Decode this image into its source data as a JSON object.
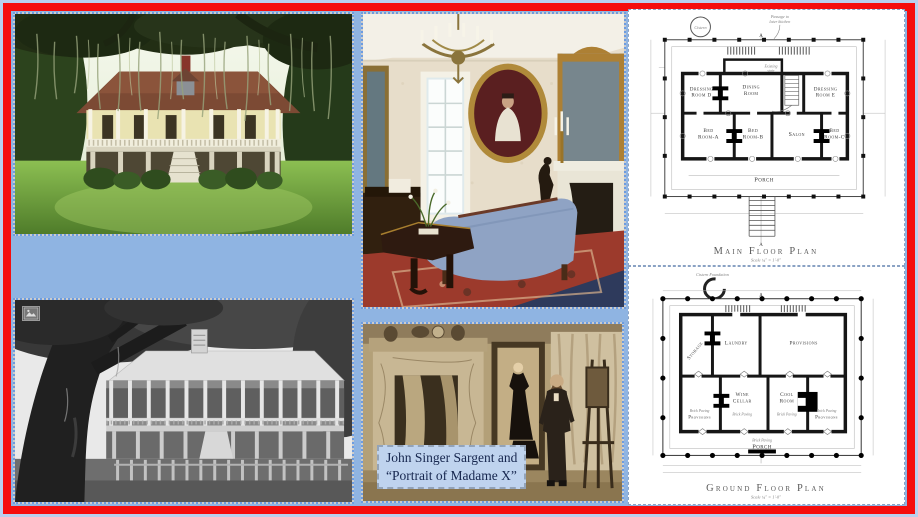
{
  "page": {
    "background": "#8fb4e2",
    "outer_edge": "#b9d0ee",
    "frame_color": "#f50d0d",
    "selection_dash_color": "#6d9ce0"
  },
  "icons": {
    "picture_placeholder": "picture-icon"
  },
  "caption": {
    "line1": "John Singer Sargent and",
    "line2": "“Portrait of Madame X”",
    "bg": "#bfd3ee",
    "text_color": "#16264e"
  },
  "plans": {
    "main": {
      "title": "Main Floor Plan",
      "scale": "Scale ¼\" = 1'-0\"",
      "cistern": "Cistern",
      "passage_1": "Passage to",
      "passage_2": "later kitchen",
      "stair_1": "Existing",
      "stair_2": "stair",
      "section_marker": "A",
      "rooms": {
        "dressing_d_1": "Dressing",
        "dressing_d_2": "Room D",
        "dining_1": "Dining",
        "dining_2": "Room",
        "dressing_e_1": "Dressing",
        "dressing_e_2": "Room E",
        "bed_a_1": "Bed",
        "bed_a_2": "Room-A",
        "bed_b_1": "Bed",
        "bed_b_2": "Room-B",
        "salon": "Salon",
        "bed_c_1": "Bed",
        "bed_c_2": "Room-C",
        "porch": "Porch"
      }
    },
    "ground": {
      "title": "Ground Floor Plan",
      "scale": "Scale ¼\" = 1'-0\"",
      "cistern": "Cistern Foundation",
      "section_marker": "A",
      "rooms": {
        "storage": "Storage",
        "laundry": "Laundry",
        "provisions_top": "Provisions",
        "wine_1": "Wine",
        "wine_2": "Cellar",
        "cool_1": "Cool",
        "cool_2": "Room",
        "provisions_left": "Provisions",
        "provisions_right": "Provisions",
        "brick_paving": "Brick Paving",
        "porch": "Porch"
      }
    }
  }
}
